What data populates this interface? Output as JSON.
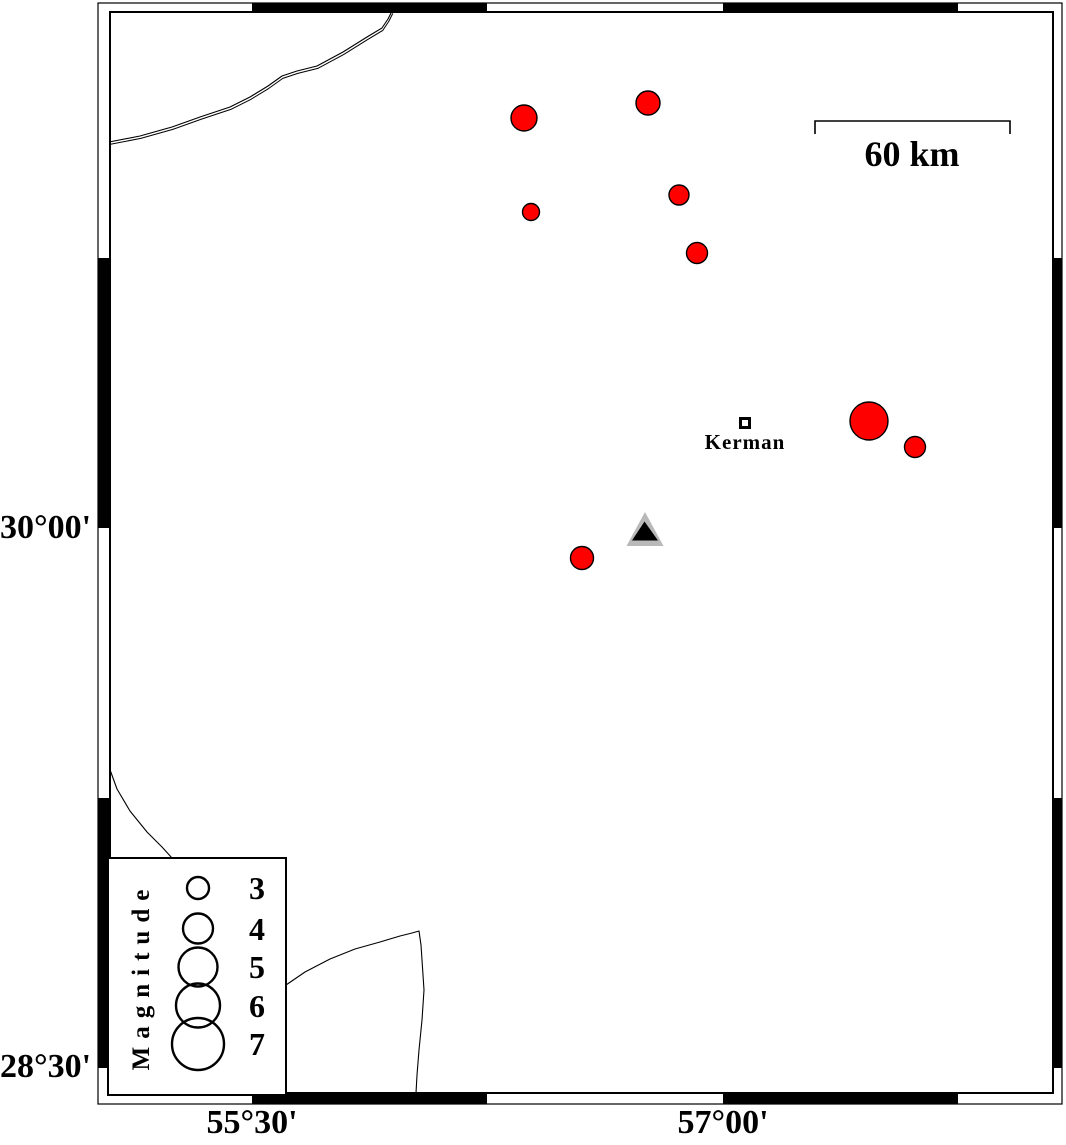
{
  "map": {
    "size": {
      "width": 1066,
      "height": 1145
    },
    "projection_note": "lat/lon graticule map, GMT-style fancy frame, 45-minute alternation",
    "frame": {
      "outer": {
        "x": 98,
        "y": 3,
        "w": 964,
        "h": 1101
      },
      "inner": {
        "x": 110,
        "y": 12,
        "w": 943,
        "h": 1081
      },
      "band_color": "#ffffff",
      "segment_color": "#000000",
      "top_black_segments": [
        [
          252,
          487
        ],
        [
          723,
          958
        ]
      ],
      "bottom_black_segments": [
        [
          252,
          487
        ],
        [
          723,
          958
        ]
      ],
      "left_black_segments": [
        [
          258,
          528
        ],
        [
          798,
          1068
        ]
      ],
      "right_black_segments": [
        [
          258,
          528
        ],
        [
          798,
          1068
        ]
      ]
    },
    "axis_labels": [
      {
        "text": "30°00'",
        "side": "left",
        "x": 86,
        "y": 528
      },
      {
        "text": "28°30'",
        "side": "left",
        "x": 86,
        "y": 1067
      },
      {
        "text": "55°30'",
        "side": "bottom",
        "x": 252,
        "y": 1124
      },
      {
        "text": "57°00'",
        "side": "bottom",
        "x": 723,
        "y": 1124
      }
    ],
    "scale_bar": {
      "label": "60 km",
      "x1": 815,
      "x2": 1010,
      "y": 121,
      "tick_len": 13,
      "label_cx": 912,
      "label_cy": 154
    },
    "city": {
      "label": "Kerman",
      "x": 745,
      "y": 423,
      "lon_est": 57.07,
      "lat_est": 30.29,
      "marker": "open-square"
    },
    "station": {
      "x": 645,
      "y": 533,
      "lon_est": 56.75,
      "lat_est": 29.99,
      "symbol": "triangle",
      "halo_color": "#b9b9b9",
      "core_color": "#000000"
    },
    "faults": [
      {
        "name": "fault-line-northwest",
        "double_line": true,
        "points": "109,142 140,136 172,127 200,117 230,107 250,97 268,86 282,76 297,71 317,66 343,52 367,37 382,28 388,19 392,11"
      },
      {
        "name": "fault-line-southwest-upper",
        "points": "109,767 117,789 130,811 147,832 162,847 172,858"
      },
      {
        "name": "fault-line-south-ridge",
        "points": "286,985 305,972 330,959 355,949 380,942 400,936 412,933 419,931 421,945 423,975 424,990 422,1020 419,1050 417,1075 416,1093"
      }
    ],
    "earthquakes": [
      {
        "x": 524,
        "y": 118,
        "r": 13,
        "lon_est": 56.37,
        "lat_est": 31.14,
        "mag_est": 3.5
      },
      {
        "x": 648,
        "y": 103,
        "r": 12,
        "lon_est": 56.76,
        "lat_est": 31.18,
        "mag_est": 3.3
      },
      {
        "x": 531,
        "y": 212,
        "r": 8.5,
        "lon_est": 56.39,
        "lat_est": 30.88,
        "mag_est": 2.3
      },
      {
        "x": 679,
        "y": 195,
        "r": 10,
        "lon_est": 56.86,
        "lat_est": 30.93,
        "mag_est": 2.7
      },
      {
        "x": 697,
        "y": 253,
        "r": 10.5,
        "lon_est": 56.92,
        "lat_est": 30.76,
        "mag_est": 2.9
      },
      {
        "x": 869,
        "y": 421,
        "r": 19,
        "lon_est": 57.47,
        "lat_est": 30.3,
        "mag_est": 5.1
      },
      {
        "x": 915,
        "y": 447,
        "r": 10.5,
        "lon_est": 57.61,
        "lat_est": 30.23,
        "mag_est": 2.9
      },
      {
        "x": 582,
        "y": 558,
        "r": 11.5,
        "lon_est": 56.55,
        "lat_est": 29.92,
        "mag_est": 3.1
      }
    ],
    "legend": {
      "title": "Magnitude",
      "box": {
        "x": 108,
        "y": 858,
        "w": 178,
        "h": 237
      },
      "circle_cx": 198,
      "label_cx": 257,
      "entries": [
        {
          "mag": "3",
          "cy": 888,
          "r": 11
        },
        {
          "mag": "4",
          "cy": 928.5,
          "r": 15
        },
        {
          "mag": "5",
          "cy": 967,
          "r": 19.5
        },
        {
          "mag": "6",
          "cy": 1005.5,
          "r": 22
        },
        {
          "mag": "7",
          "cy": 1044,
          "r": 26
        }
      ]
    },
    "colors": {
      "epicenter_fill": "#ff0000",
      "outline": "#000000",
      "station_halo": "#b9b9b9",
      "background": "#ffffff"
    }
  },
  "chart_data": {
    "type": "scatter",
    "title": "",
    "xlabel": "longitude",
    "ylabel": "latitude",
    "x_ticks": [
      "55°30'",
      "57°00'"
    ],
    "y_ticks": [
      "30°00'",
      "28°30'"
    ],
    "legend_title": "Magnitude",
    "legend_values": [
      3,
      4,
      5,
      6,
      7
    ],
    "scale_bar_km": 60,
    "series": [
      {
        "name": "earthquake-epicenters",
        "points": [
          {
            "lon": 56.37,
            "lat": 31.14,
            "mag": 3.5
          },
          {
            "lon": 56.76,
            "lat": 31.18,
            "mag": 3.3
          },
          {
            "lon": 56.39,
            "lat": 30.88,
            "mag": 2.3
          },
          {
            "lon": 56.86,
            "lat": 30.93,
            "mag": 2.7
          },
          {
            "lon": 56.92,
            "lat": 30.76,
            "mag": 2.9
          },
          {
            "lon": 57.47,
            "lat": 30.3,
            "mag": 5.1
          },
          {
            "lon": 57.61,
            "lat": 30.23,
            "mag": 2.9
          },
          {
            "lon": 56.55,
            "lat": 29.92,
            "mag": 3.1
          }
        ]
      },
      {
        "name": "city",
        "points": [
          {
            "label": "Kerman",
            "lon": 57.07,
            "lat": 30.29
          }
        ]
      },
      {
        "name": "station",
        "points": [
          {
            "lon": 56.75,
            "lat": 29.99
          }
        ]
      }
    ]
  }
}
